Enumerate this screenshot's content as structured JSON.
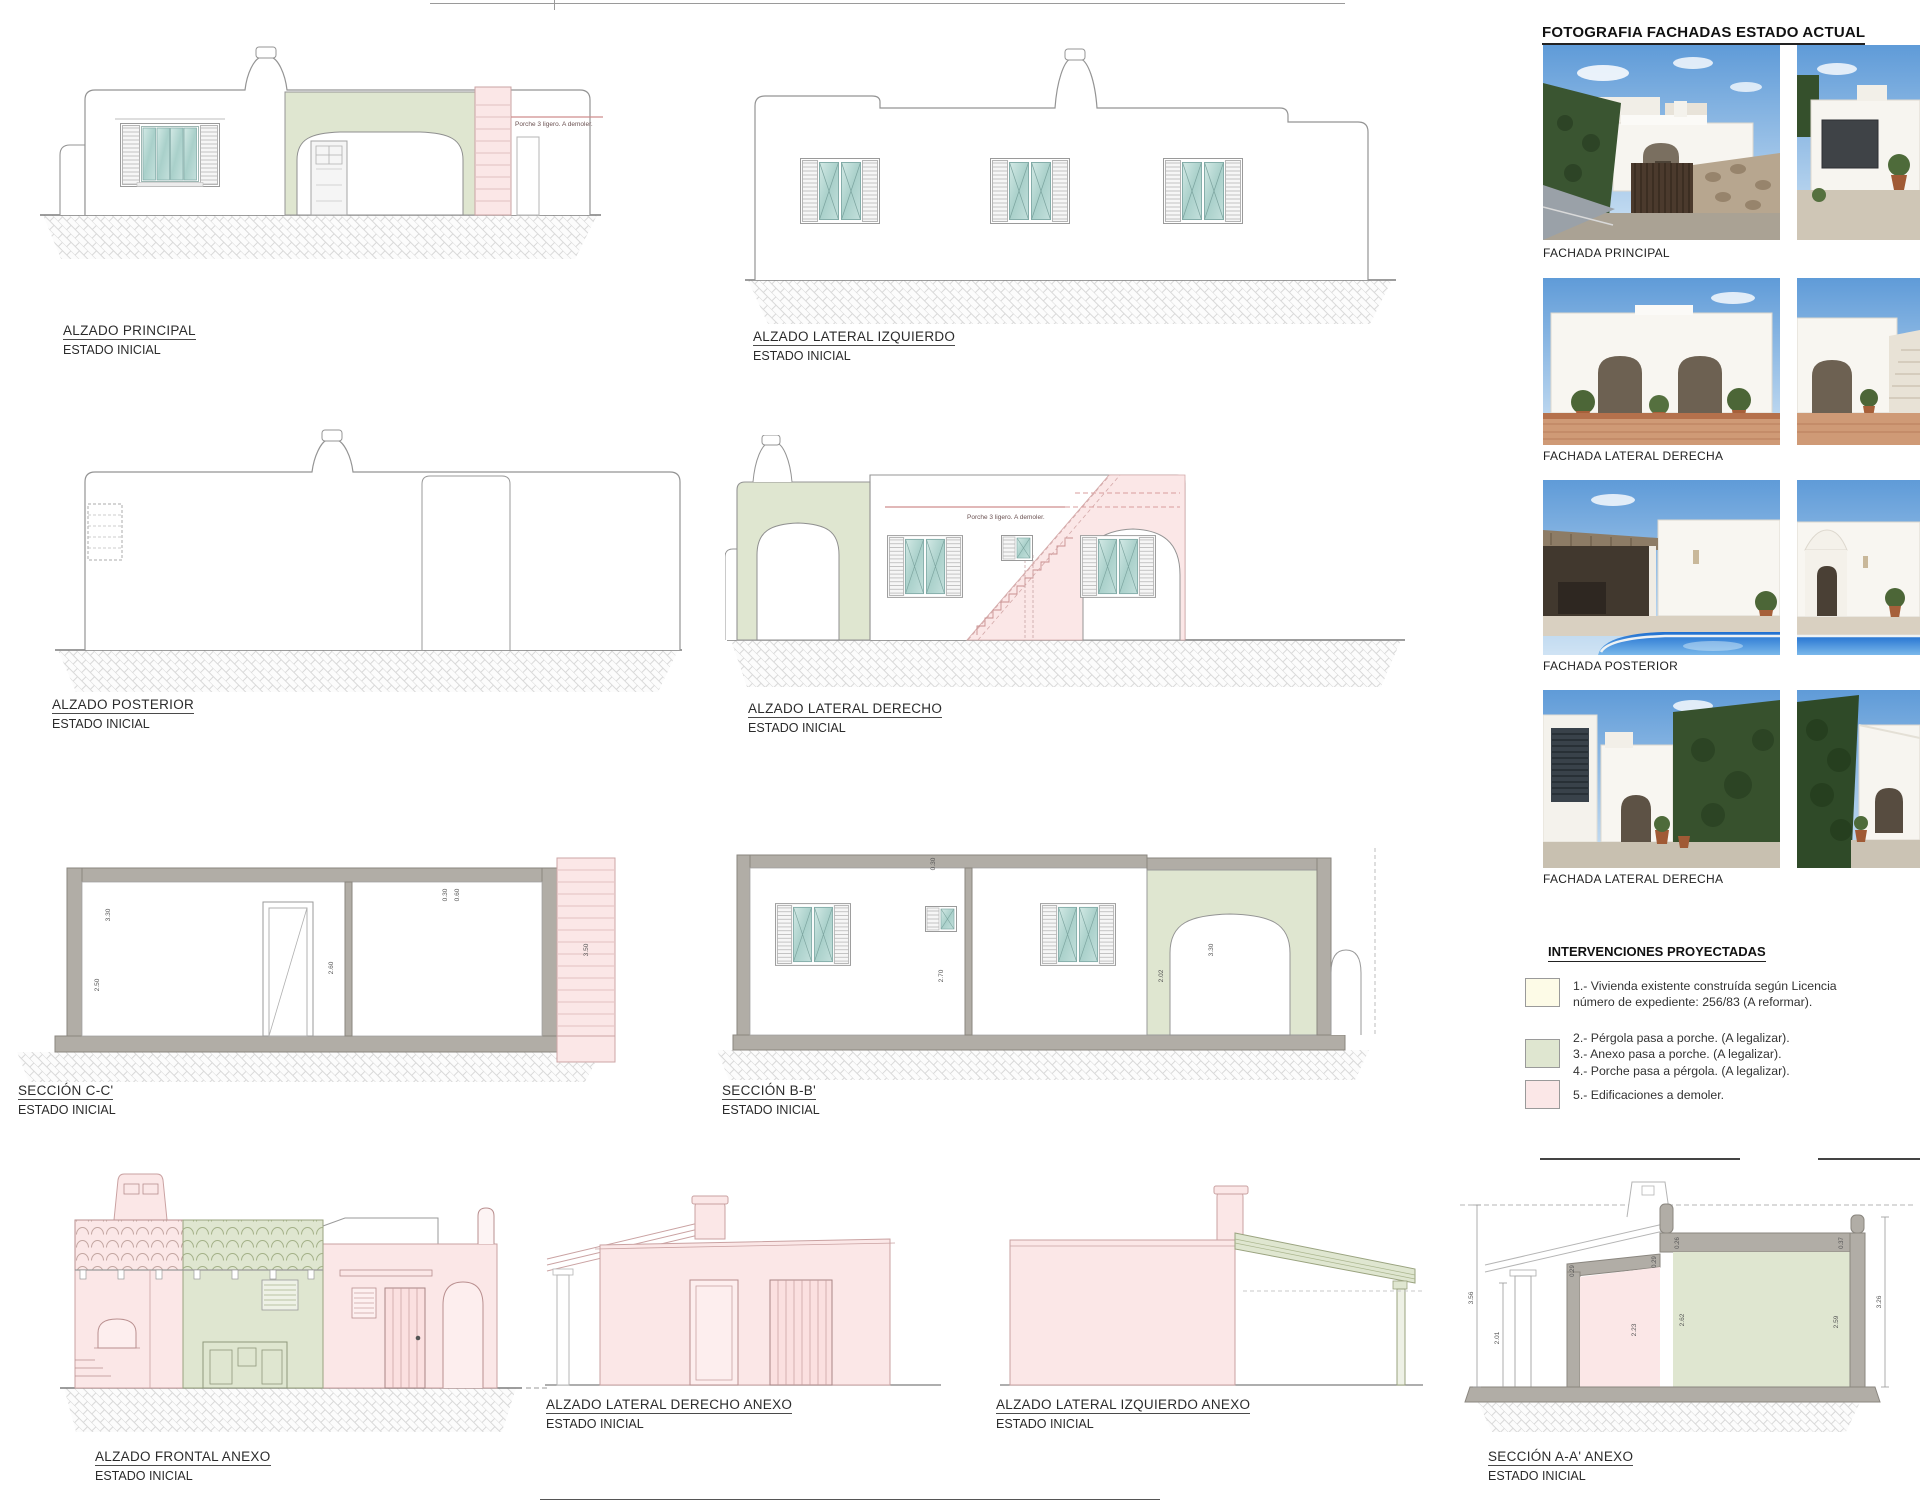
{
  "colors": {
    "accent_green": "#dfe6d0",
    "accent_pink": "#fbe7e7",
    "accent_cream": "#fdfbe7",
    "pool_blue": "#2f7fd6"
  },
  "drawings": {
    "alzado_principal": {
      "title": "ALZADO PRINCIPAL",
      "subtitle": "ESTADO INICIAL",
      "annotation": "Porche 3 ligero. A demoler."
    },
    "alzado_lateral_izquierdo": {
      "title": "ALZADO LATERAL IZQUIERDO",
      "subtitle": "ESTADO INICIAL"
    },
    "alzado_posterior": {
      "title": "ALZADO POSTERIOR",
      "subtitle": "ESTADO INICIAL"
    },
    "alzado_lateral_derecho": {
      "title": "ALZADO LATERAL DERECHO",
      "subtitle": "ESTADO INICIAL",
      "annotation": "Porche 3 ligero. A demoler."
    },
    "seccion_cc": {
      "title": "SECCIÓN C-C'",
      "subtitle": "ESTADO INICIAL",
      "dims": {
        "a": "3.30",
        "b": "2.50",
        "c": "2.60",
        "d": "0.30",
        "e": "0.60",
        "f": "3.50"
      }
    },
    "seccion_bb": {
      "title": "SECCIÓN B-B'",
      "subtitle": "ESTADO INICIAL",
      "dims": {
        "a": "0.30",
        "b": "2.70",
        "c": "2.02",
        "d": "3.30"
      }
    },
    "alzado_frontal_anexo": {
      "title": "ALZADO FRONTAL ANEXO",
      "subtitle": "ESTADO INICIAL"
    },
    "alzado_lateral_derecho_anexo": {
      "title": "ALZADO LATERAL DERECHO ANEXO",
      "subtitle": "ESTADO INICIAL"
    },
    "alzado_lateral_izquierdo_anexo": {
      "title": "ALZADO LATERAL IZQUIERDO  ANEXO",
      "subtitle": "ESTADO INICIAL"
    },
    "seccion_aa_anexo": {
      "title": "SECCIÓN A-A' ANEXO",
      "subtitle": "ESTADO INICIAL",
      "dims": {
        "a": "3.56",
        "b": "2.01",
        "c": "0.29",
        "d": "0.29",
        "e": "2.23",
        "f": "0.26",
        "g": "2.62",
        "h": "0.37",
        "i": "2.59",
        "j": "3.26"
      }
    }
  },
  "photos": {
    "title": "FOTOGRAFIA FACHADAS ESTADO ACTUAL",
    "labels": [
      "FACHADA PRINCIPAL",
      "FACHADA LATERAL DERECHA",
      "FACHADA  POSTERIOR",
      "FACHADA  LATERAL DERECHA"
    ]
  },
  "legend": {
    "title": "INTERVENCIONES PROYECTADAS",
    "items": [
      {
        "swatch": "cream",
        "line1": "1.- Vivienda existente construída según Licencia",
        "line2": "número de expediente: 256/83 (A reformar)."
      },
      {
        "swatch": "green",
        "line1": "2.- Pérgola pasa a porche. (A legalizar).",
        "line2": "3.- Anexo pasa a porche. (A legalizar).",
        "line3": "4.- Porche pasa a pérgola. (A legalizar)."
      },
      {
        "swatch": "pink",
        "line1": "5.- Edificaciones a demoler."
      }
    ]
  }
}
